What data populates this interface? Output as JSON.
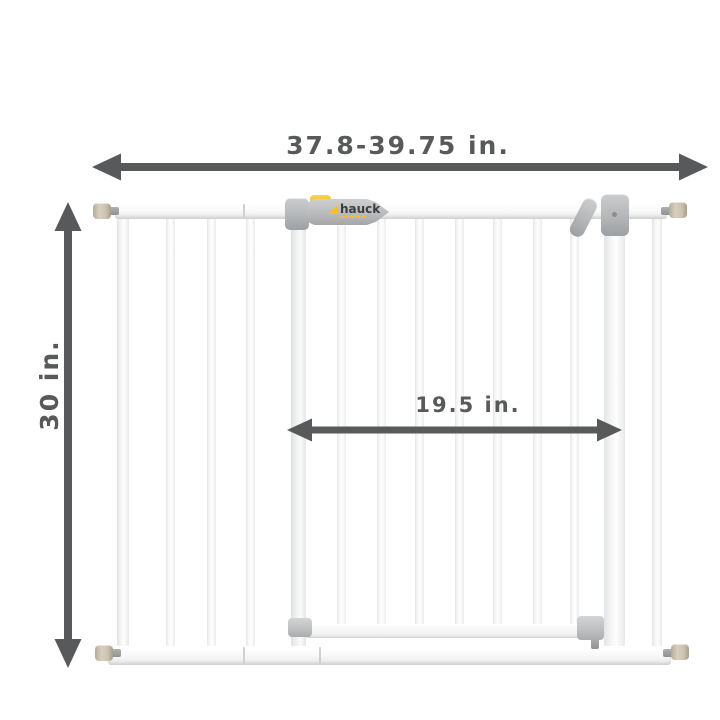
{
  "brand": {
    "name": "hauck"
  },
  "dimensions": {
    "overall_width": "37.8-39.75 in.",
    "height": "30 in.",
    "door_width": "19.5 in."
  },
  "illustration": {
    "subject": "white metal pressure-mounted baby safety gate with extension panel and swing door",
    "arrow_style": "double-headed measurement arrows"
  },
  "colors": {
    "annotation_gray": "#58595b",
    "accent_yellow": "#f2c41d",
    "hardware_gray": "#b4b6b8",
    "knob_beige": "#cdc3b1",
    "background": "#ffffff"
  }
}
